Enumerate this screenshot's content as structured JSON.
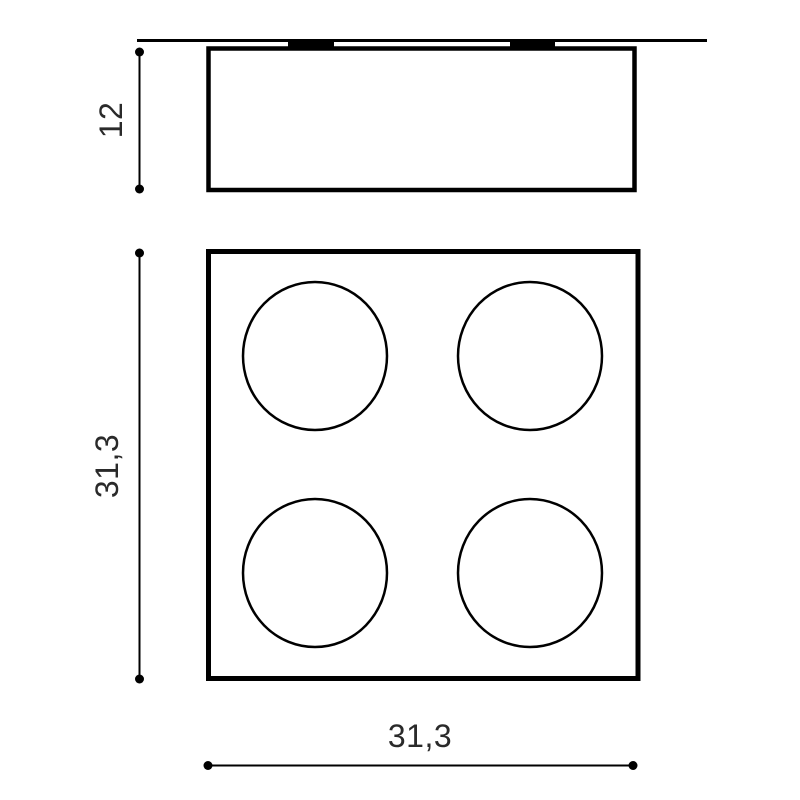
{
  "drawing": {
    "type": "technical-dimension-drawing",
    "views": {
      "side": {
        "name": "side-elevation",
        "height_dim": "12"
      },
      "bottom": {
        "name": "bottom-view-four-spots",
        "height_dim": "31,3",
        "width_dim": "31,3"
      }
    },
    "colors": {
      "line": "#000000",
      "text": "#2a2a2a",
      "background": "#ffffff"
    }
  }
}
